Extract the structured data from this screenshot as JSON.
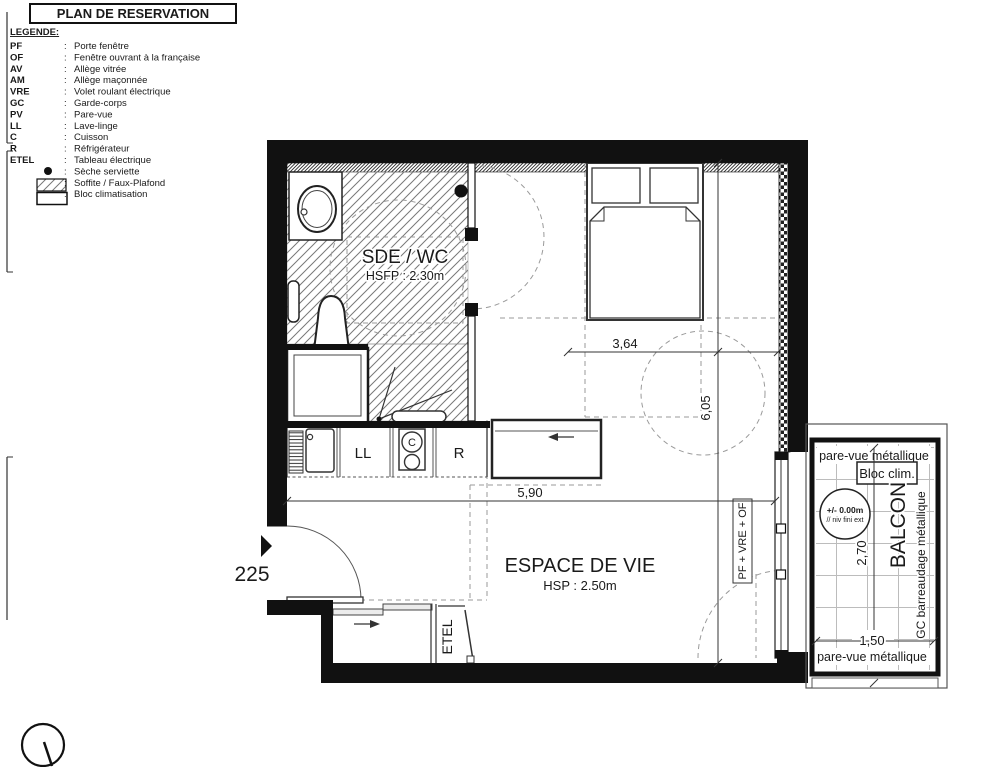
{
  "title": "PLAN DE RESERVATION",
  "legend": {
    "heading": "LEGENDE:",
    "separator": ":",
    "items": [
      {
        "abbr": "PF",
        "label": "Porte fenêtre"
      },
      {
        "abbr": "OF",
        "label": "Fenêtre ouvrant à la française"
      },
      {
        "abbr": "AV",
        "label": "Allège vitrée"
      },
      {
        "abbr": "AM",
        "label": "Allège maçonnée"
      },
      {
        "abbr": "VRE",
        "label": "Volet roulant électrique"
      },
      {
        "abbr": "GC",
        "label": "Garde-corps"
      },
      {
        "abbr": "PV",
        "label": "Pare-vue"
      },
      {
        "abbr": "LL",
        "label": "Lave-linge"
      },
      {
        "abbr": "C",
        "label": "Cuisson"
      },
      {
        "abbr": "R",
        "label": "Réfrigérateur"
      },
      {
        "abbr": "ETEL",
        "label": "Tableau électrique"
      },
      {
        "abbr": "",
        "label": "Sèche serviette",
        "icon": "dot-icon"
      },
      {
        "abbr": "",
        "label": "Soffite / Faux-Plafond",
        "icon": "hatch-swatch-icon"
      },
      {
        "abbr": "",
        "label": "Bloc climatisation",
        "icon": "rect-swatch-icon"
      }
    ]
  },
  "plan": {
    "door_number": "225",
    "rooms": {
      "bathroom": {
        "name": "SDE / WC",
        "ceiling": "HSFP : 2.30m"
      },
      "living": {
        "name": "ESPACE DE VIE",
        "ceiling": "HSP : 2.50m"
      },
      "balcony": {
        "name": "BALCON"
      }
    },
    "appliances": {
      "washer": "LL",
      "cooktop": "C",
      "fridge": "R",
      "electrical_panel": "ETEL",
      "bloc_clim": "Bloc clim."
    },
    "window_label": "PF + VRE + OF",
    "balcony_labels": {
      "top": "pare-vue métallique",
      "bottom": "pare-vue métallique",
      "railing": "GC barreaudage métallique"
    },
    "level_marker": {
      "value": "+/- 0.00m",
      "note": "// niv fini ext"
    },
    "dimensions": {
      "bedroom_width": "3,64",
      "total_depth": "6,05",
      "living_width": "5,90",
      "balcony_depth": "2,70",
      "balcony_width": "1,50"
    },
    "colors": {
      "line": "#1a1a1a",
      "guide": "#9a9a9a"
    }
  }
}
